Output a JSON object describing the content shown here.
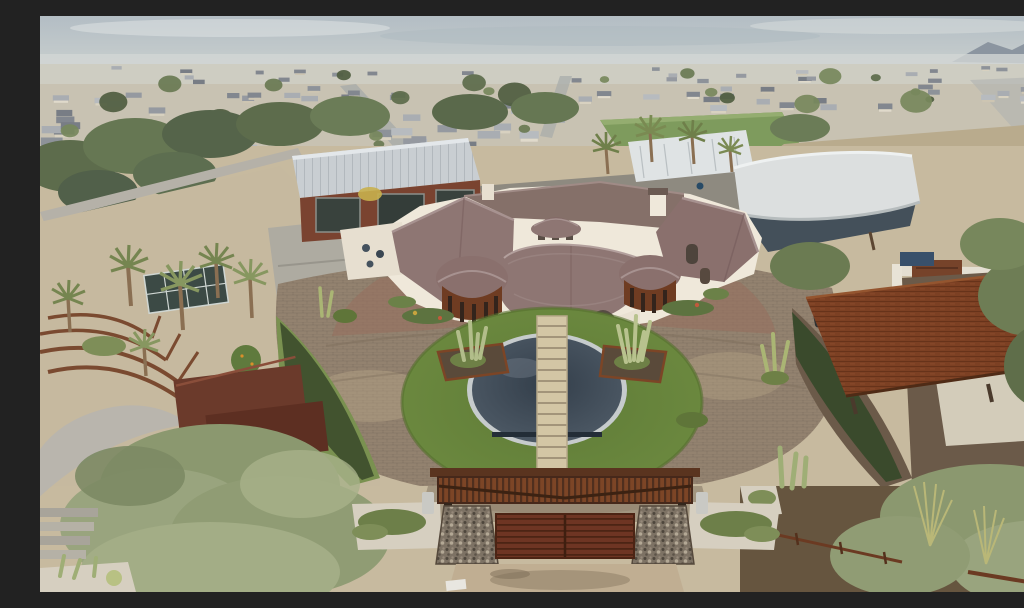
{
  "scene": {
    "type": "aerial-photograph",
    "title": "Aerial view of a luxury desert estate with circular motor court",
    "sky": "overcast grey-blue with distant mountain at right",
    "background": "dense suburban tract homes to the horizon, green park field and tan dirt field with perimeter road at right",
    "estate_elements": [
      "mediterranean-mansion-with-rotunda-portico",
      "oval-lawn-with-slate-reflecting-pool",
      "stepping-stone-path",
      "paver-motor-court",
      "corten-barn-with-glass-doors",
      "white-tensile-canopy-over-court",
      "corten-carport-with-vehicles",
      "entry-gate-with-gabion-pillars-and-pergola",
      "amphitheater-garden-with-palms-and-greenhouse",
      "desert-planting-beds-with-cacti"
    ]
  },
  "palette": {
    "sky": "#b6c0c6",
    "sky_haze": "#d2d6d5",
    "mountain": "#8b95a0",
    "suburb_ground": "#c8c2b2",
    "field_green": "#7e9b5d",
    "field_tan": "#c2a87e",
    "road": "#a7aba9",
    "estate_ground": "#c7ba9f",
    "paver": "#93826f",
    "paver_red": "#97705c",
    "lawn": "#6d8a40",
    "pool_water": "#47525f",
    "pool_rim": "#c6cbcc",
    "path_stone": "#d3c6a5",
    "house_wall": "#efe8da",
    "house_roof": "#8e7673",
    "corten": "#7c4526",
    "barn_wall": "#7a4330",
    "metal_roof": "#c9ced2",
    "canopy": "#dcdfdf",
    "gate_wood": "#6e3523",
    "gabion": "#7d7264",
    "hedge": "#3f5230",
    "soil": "#66553f",
    "sage_tree": "#99a47e",
    "concrete": "#d6cfc0"
  },
  "suburb": {
    "seed": 12,
    "house_count": 130,
    "tree_count": 42,
    "band_top": 50,
    "band_bottom": 138,
    "roof_colors": [
      "#82878f",
      "#9599a0",
      "#a9adb2",
      "#787d85",
      "#b7bbbf",
      "#8d9299"
    ],
    "wall_colors": [
      "#d8d1c0",
      "#cdc5b2",
      "#e0dacb"
    ],
    "tree_colors": [
      "#5c6b4b",
      "#697a53",
      "#77885c",
      "#4f5d40"
    ]
  }
}
